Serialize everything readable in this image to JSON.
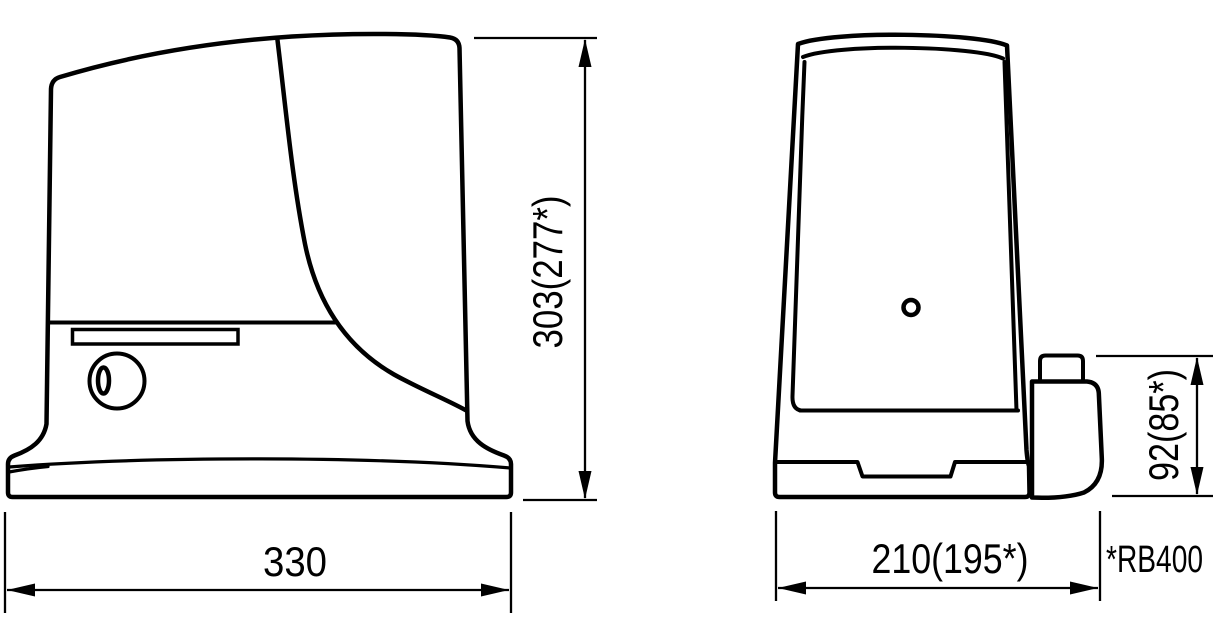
{
  "diagram": {
    "dimensions": {
      "width": {
        "label": "330"
      },
      "height": {
        "label": "303(277*)"
      },
      "depth": {
        "label": "210(195*)"
      },
      "pinion_height": {
        "label": "92(85*)"
      }
    },
    "footnote": {
      "label": "*RB400"
    },
    "colors": {
      "line": "#000000",
      "background": "#ffffff"
    }
  }
}
